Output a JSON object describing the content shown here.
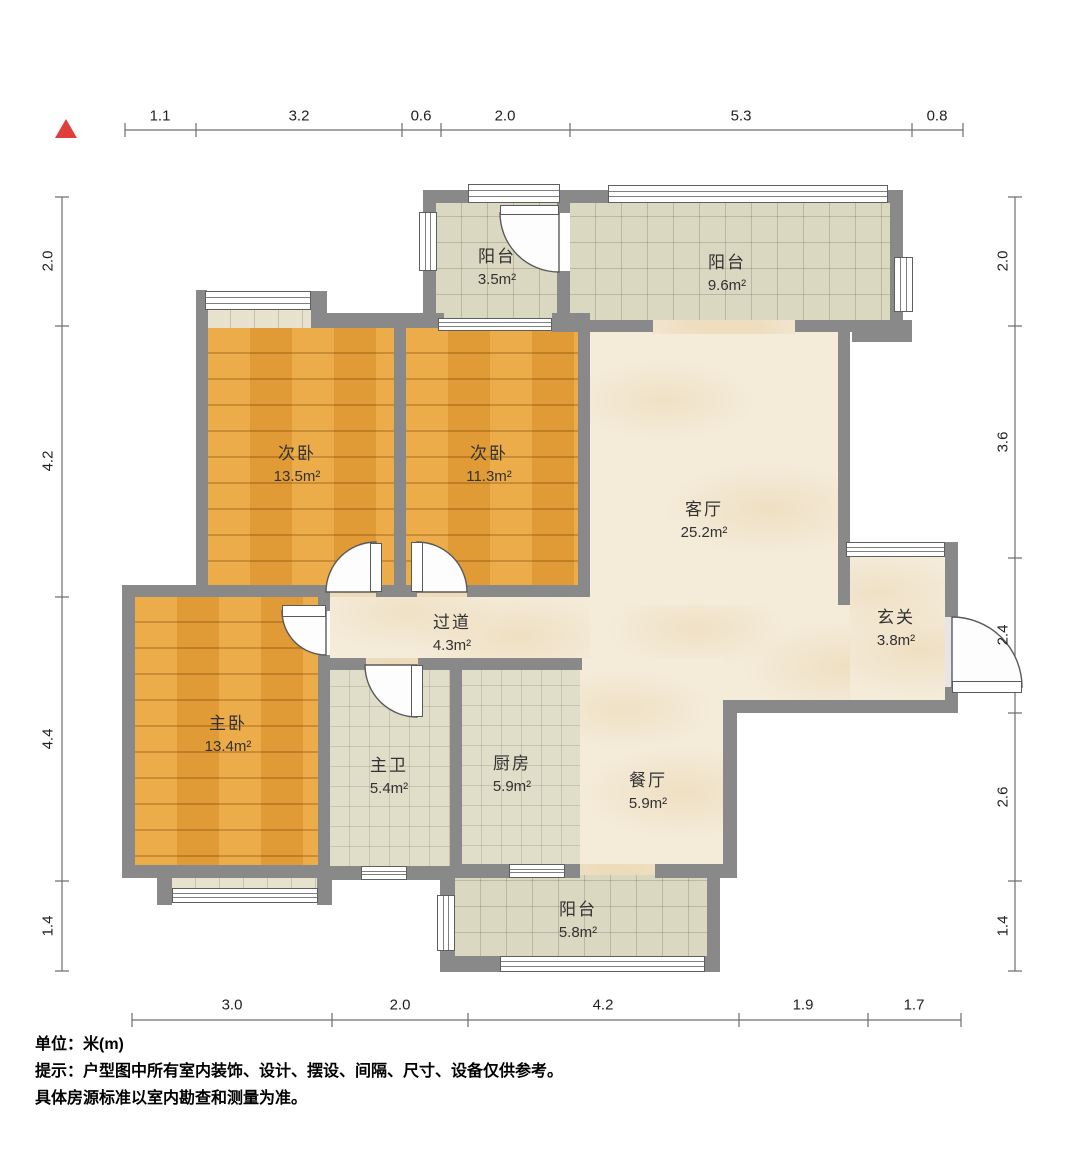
{
  "meta": {
    "type": "residential-floor-plan",
    "unit_system": "meters"
  },
  "north_marker": {
    "shape": "triangle",
    "color": "#e03e3a"
  },
  "rooms": [
    {
      "id": "balcony-north-small",
      "name": "阳台",
      "area": "3.5m²"
    },
    {
      "id": "balcony-north-large",
      "name": "阳台",
      "area": "9.6m²"
    },
    {
      "id": "bedroom-second-left",
      "name": "次卧",
      "area": "13.5m²"
    },
    {
      "id": "bedroom-second-right",
      "name": "次卧",
      "area": "11.3m²"
    },
    {
      "id": "living-room",
      "name": "客厅",
      "area": "25.2m²"
    },
    {
      "id": "foyer",
      "name": "玄关",
      "area": "3.8m²"
    },
    {
      "id": "hallway",
      "name": "过道",
      "area": "4.3m²"
    },
    {
      "id": "master-bedroom",
      "name": "主卧",
      "area": "13.4m²"
    },
    {
      "id": "master-bathroom",
      "name": "主卫",
      "area": "5.4m²"
    },
    {
      "id": "kitchen",
      "name": "厨房",
      "area": "5.9m²"
    },
    {
      "id": "dining-room",
      "name": "餐厅",
      "area": "5.9m²"
    },
    {
      "id": "balcony-south",
      "name": "阳台",
      "area": "5.8m²"
    }
  ],
  "dimensions": {
    "top": [
      "1.1",
      "3.2",
      "0.6",
      "2.0",
      "5.3",
      "0.8"
    ],
    "bottom": [
      "3.0",
      "2.0",
      "4.2",
      "1.9",
      "1.7"
    ],
    "left": [
      "2.0",
      "4.2",
      "4.4",
      "1.4"
    ],
    "right": [
      "2.0",
      "3.6",
      "2.4",
      "2.6",
      "1.4"
    ]
  },
  "footer": {
    "unit": "单位：米(m)",
    "tip1": "提示：户型图中所有室内装饰、设计、摆设、间隔、尺寸、设备仅供参考。",
    "tip2": "具体房源标准以室内勘查和测量为准。"
  },
  "colors": {
    "wall": "#898989",
    "wood_floor": "#eca63c",
    "balcony_tile": "#dbd8c2",
    "bath_kitchen_tile": "#e0ddc8",
    "marble_floor": "#f4ebd9",
    "dimension_line": "#6f6f6f",
    "north_marker": "#e03e3a",
    "background": "#ffffff"
  }
}
